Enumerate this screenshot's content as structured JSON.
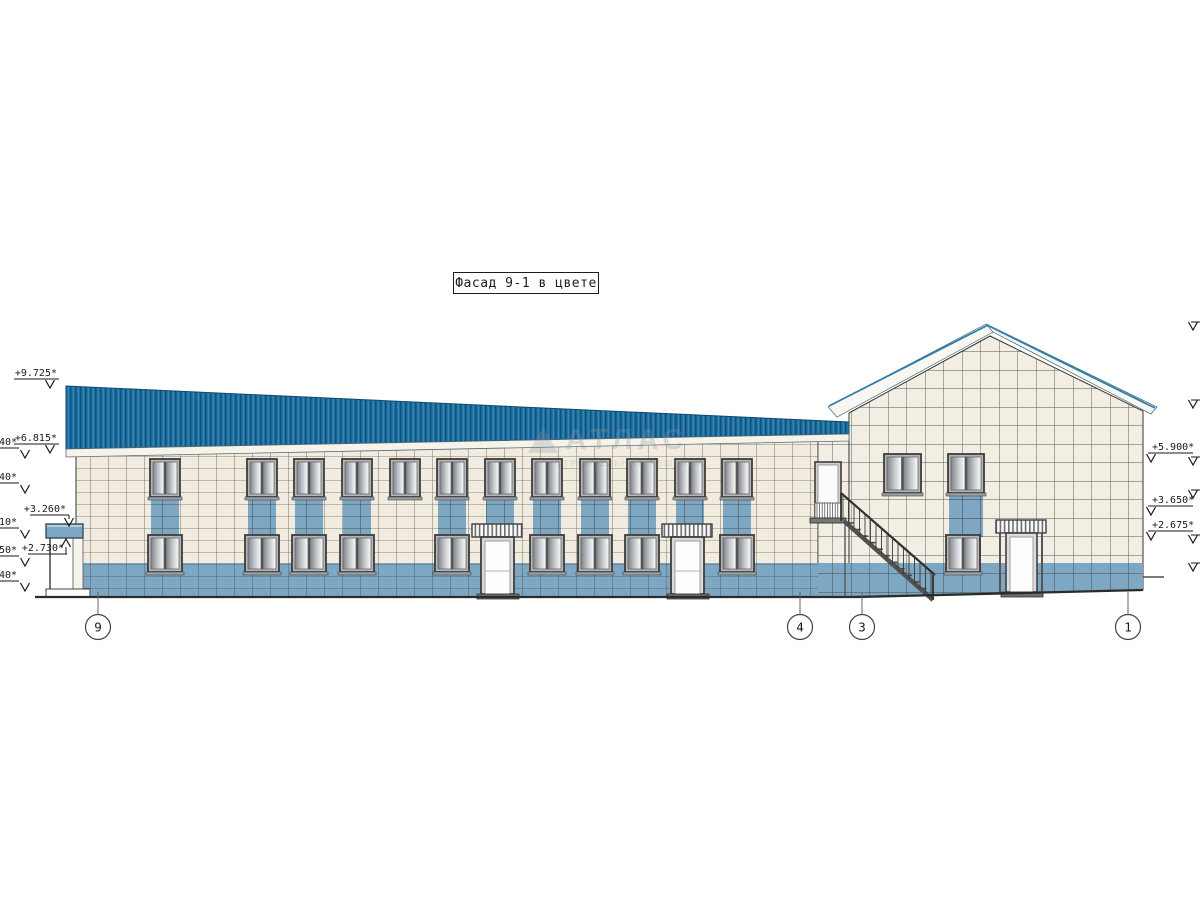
{
  "title": "Фасад 9-1 в цвете",
  "watermark": {
    "brand": "АТЛАС",
    "tagline": "СТРОИТЕЛЬНЫЕ РЕШЕНИЯ"
  },
  "colors": {
    "roof_blue": "#1e6fa2",
    "accent_blue": "#7ea7c3",
    "wall_cream": "#f1ecdf",
    "fascia_white": "#f5f3ea",
    "line_dark": "#2b2b28"
  },
  "elevation_marks": {
    "left": [
      {
        "label": "+9.725*",
        "x": 57,
        "y": 376
      },
      {
        "label": "+6.815*",
        "x": 57,
        "y": 441
      }
    ],
    "left_edge_fragments": [
      {
        "label": "40*",
        "y": 445
      },
      {
        "label": "40*",
        "y": 480
      },
      {
        "label": "10*",
        "y": 525
      },
      {
        "label": "50*",
        "y": 553
      },
      {
        "label": "40*",
        "y": 578
      }
    ],
    "right": [
      {
        "label": "+5.900*",
        "y": 450
      },
      {
        "label": "+3.650*",
        "y": 503
      },
      {
        "label": "+2.675*",
        "y": 528
      }
    ],
    "right_edge_arrows_y": [
      322,
      400,
      457,
      490,
      535,
      563
    ],
    "canopy": [
      {
        "label": "+3.260*",
        "y": 512,
        "dir": "down"
      },
      {
        "label": "+2.730*",
        "y": 551,
        "dir": "up"
      }
    ]
  },
  "axis_bubbles": [
    {
      "label": "9",
      "x": 98
    },
    {
      "label": "4",
      "x": 800
    },
    {
      "label": "3",
      "x": 862
    },
    {
      "label": "1",
      "x": 1128
    }
  ]
}
